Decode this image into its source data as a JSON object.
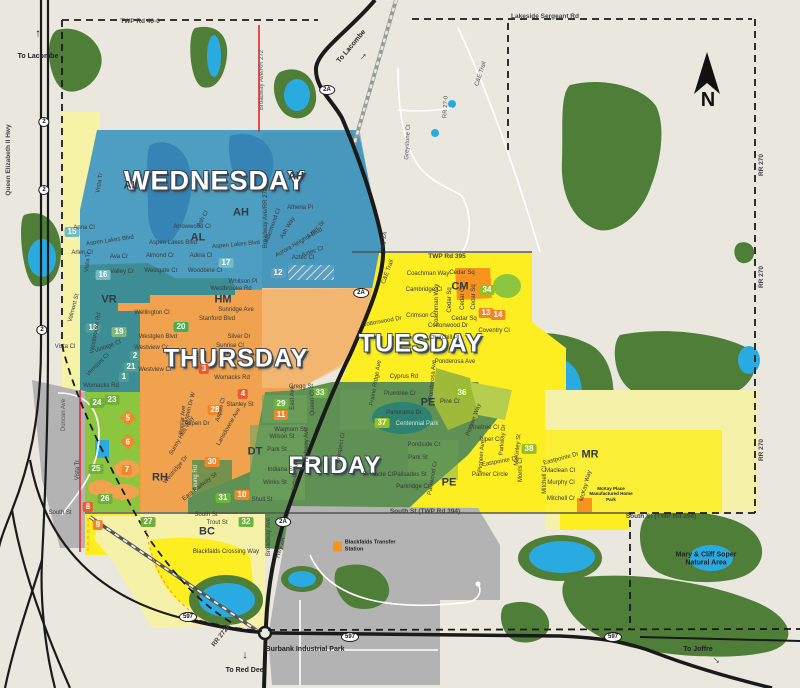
{
  "colors": {
    "background": "#EAE8DE",
    "wednesday_blue": "#4E9EC1",
    "wednesday_teal": "#3D8D95",
    "thursday_orange": "#F0A24E",
    "tuesday_yellow": "#FCEE21",
    "tuesday_pale": "#F5F1A9",
    "friday_green": "#5E9153",
    "green_space": "#8CC63F",
    "forest": "#4F7E38",
    "water": "#29ABE2",
    "industrial_gray": "#B3B3B3",
    "badge_orange": "#F0882B",
    "badge_green": "#6DB33F",
    "badge_teal": "#4E9E96",
    "road_red": "#E8232A"
  },
  "compass": {
    "label": "N"
  },
  "day_labels": [
    {
      "t": "WEDNESDAY",
      "x": 215,
      "y": 181,
      "s": 27
    },
    {
      "t": "THURSDAY",
      "x": 236,
      "y": 359,
      "s": 25
    },
    {
      "t": "TUESDAY",
      "x": 421,
      "y": 344,
      "s": 25
    },
    {
      "t": "FRIDAY",
      "x": 335,
      "y": 466,
      "s": 24
    }
  ],
  "area_labels": [
    {
      "t": "AH",
      "x": 296,
      "y": 177
    },
    {
      "t": "AH",
      "x": 241,
      "y": 213
    },
    {
      "t": "AL",
      "x": 131,
      "y": 186
    },
    {
      "t": "AL",
      "x": 198,
      "y": 238
    },
    {
      "t": "VR",
      "x": 109,
      "y": 300
    },
    {
      "t": "HM",
      "x": 223,
      "y": 300
    },
    {
      "t": "RH",
      "x": 160,
      "y": 478
    },
    {
      "t": "DT",
      "x": 255,
      "y": 452
    },
    {
      "t": "PE",
      "x": 428,
      "y": 403
    },
    {
      "t": "PE",
      "x": 449,
      "y": 483
    },
    {
      "t": "CM",
      "x": 460,
      "y": 287
    },
    {
      "t": "MR",
      "x": 590,
      "y": 455
    },
    {
      "t": "BC",
      "x": 207,
      "y": 532
    }
  ],
  "zone_badges": [
    {
      "n": "15",
      "x": 72,
      "y": 232,
      "bg": "#74BBC9"
    },
    {
      "n": "16",
      "x": 103,
      "y": 275,
      "bg": "#74BBC9"
    },
    {
      "n": "17",
      "x": 226,
      "y": 263,
      "bg": "#74BBC9"
    },
    {
      "n": "12",
      "x": 278,
      "y": 273,
      "bg": "#5B9EC0"
    },
    {
      "n": "18",
      "x": 93,
      "y": 328,
      "bg": "#4E9E96"
    },
    {
      "n": "19",
      "x": 119,
      "y": 332,
      "bg": "#7FB97E"
    },
    {
      "n": "20",
      "x": 181,
      "y": 327,
      "bg": "#44AF4F"
    },
    {
      "n": "2",
      "x": 135,
      "y": 356,
      "bg": "#4E9E96"
    },
    {
      "n": "21",
      "x": 131,
      "y": 367,
      "bg": "#4E9E96"
    },
    {
      "n": "1",
      "x": 124,
      "y": 377,
      "bg": "#4E9E96"
    },
    {
      "n": "3",
      "x": 204,
      "y": 369,
      "bg": "#F0592B"
    },
    {
      "n": "4",
      "x": 243,
      "y": 394,
      "bg": "#F0592B"
    },
    {
      "n": "28",
      "x": 215,
      "y": 410,
      "bg": "#F0882B"
    },
    {
      "n": "29",
      "x": 281,
      "y": 404,
      "bg": "#6DB33F"
    },
    {
      "n": "11",
      "x": 281,
      "y": 415,
      "bg": "#F0882B"
    },
    {
      "n": "33",
      "x": 320,
      "y": 393,
      "bg": "#6DB33F"
    },
    {
      "n": "30",
      "x": 212,
      "y": 462,
      "bg": "#F0882B"
    },
    {
      "n": "31",
      "x": 223,
      "y": 498,
      "bg": "#6DB33F"
    },
    {
      "n": "10",
      "x": 242,
      "y": 495,
      "bg": "#F0882B"
    },
    {
      "n": "32",
      "x": 246,
      "y": 522,
      "bg": "#6DB33F"
    },
    {
      "n": "23",
      "x": 112,
      "y": 400,
      "bg": "#6FAF3A"
    },
    {
      "n": "24",
      "x": 97,
      "y": 403,
      "bg": "#6FAF3A"
    },
    {
      "n": "25",
      "x": 96,
      "y": 469,
      "bg": "#6FAF3A"
    },
    {
      "n": "26",
      "x": 105,
      "y": 499,
      "bg": "#6FAF3A"
    },
    {
      "n": "27",
      "x": 148,
      "y": 522,
      "bg": "#6FAF3A"
    },
    {
      "n": "7",
      "x": 127,
      "y": 470,
      "bg": "#F0882B"
    },
    {
      "n": "8",
      "x": 88,
      "y": 507,
      "bg": "#F0592B"
    },
    {
      "n": "9",
      "x": 98,
      "y": 525,
      "bg": "#F0882B"
    },
    {
      "n": "34",
      "x": 487,
      "y": 290,
      "bg": "#95C11F"
    },
    {
      "n": "13",
      "x": 486,
      "y": 313,
      "bg": "#F0882B"
    },
    {
      "n": "14",
      "x": 498,
      "y": 315,
      "bg": "#F0882B"
    },
    {
      "n": "36",
      "x": 462,
      "y": 393,
      "bg": "#95C11F"
    },
    {
      "n": "37",
      "x": 382,
      "y": 423,
      "bg": "#95C11F"
    },
    {
      "n": "38",
      "x": 529,
      "y": 449,
      "bg": "#95C11F"
    }
  ],
  "zone_markers": [
    {
      "n": "5",
      "x": 128,
      "y": 418,
      "bg": "#F0882B"
    },
    {
      "n": "6",
      "x": 128,
      "y": 442,
      "bg": "#F0882B"
    }
  ],
  "streets": [
    {
      "t": "Vista Tr",
      "x": 100,
      "y": 183,
      "r": -80
    },
    {
      "t": "Anna Cl",
      "x": 84,
      "y": 228
    },
    {
      "t": "Arlen Cl",
      "x": 82,
      "y": 253
    },
    {
      "t": "Ava Cr",
      "x": 119,
      "y": 257
    },
    {
      "t": "Valley Cr",
      "x": 122,
      "y": 272
    },
    {
      "t": "Aspen Lakes Blvd",
      "x": 110,
      "y": 241,
      "r": -8
    },
    {
      "t": "Aspen Lakes Blvd",
      "x": 173,
      "y": 243
    },
    {
      "t": "Aspen Lakes Blvd",
      "x": 236,
      "y": 245,
      "r": -5
    },
    {
      "t": "Arrowwood Cl",
      "x": 192,
      "y": 227
    },
    {
      "t": "Almond Cr",
      "x": 160,
      "y": 256
    },
    {
      "t": "Westgate Cr",
      "x": 161,
      "y": 271
    },
    {
      "t": "Adina Cl",
      "x": 201,
      "y": 256
    },
    {
      "t": "Woodbine Cl",
      "x": 205,
      "y": 271
    },
    {
      "t": "Ash Cl",
      "x": 203,
      "y": 219,
      "r": -60
    },
    {
      "t": "Athena Pl",
      "x": 300,
      "y": 208
    },
    {
      "t": "Aldermond Cl",
      "x": 273,
      "y": 226,
      "r": -70
    },
    {
      "t": "Ash Way",
      "x": 288,
      "y": 228,
      "r": -60
    },
    {
      "t": "Aurora Heights Blvd",
      "x": 299,
      "y": 243,
      "r": -30
    },
    {
      "t": "Aztec St",
      "x": 316,
      "y": 230,
      "r": -45
    },
    {
      "t": "Aztec Cl",
      "x": 303,
      "y": 258
    },
    {
      "t": "Aztec Cr",
      "x": 313,
      "y": 252,
      "r": -20
    },
    {
      "t": "Vista Tr",
      "x": 88,
      "y": 262,
      "r": -85
    },
    {
      "t": "Valmont St",
      "x": 74,
      "y": 308,
      "r": -75
    },
    {
      "t": "Westbrooke Rd",
      "x": 96,
      "y": 333,
      "r": -80
    },
    {
      "t": "Vintage Cl",
      "x": 108,
      "y": 347,
      "r": -20
    },
    {
      "t": "Vermont Cl",
      "x": 98,
      "y": 365,
      "r": -45
    },
    {
      "t": "Vista Cl",
      "x": 65,
      "y": 347
    },
    {
      "t": "Womacks Rd",
      "x": 101,
      "y": 386
    },
    {
      "t": "Vista Tr",
      "x": 78,
      "y": 470,
      "r": -90
    },
    {
      "t": "Duncan Ave",
      "x": 64,
      "y": 415,
      "r": -90,
      "c": "#555"
    },
    {
      "t": "Whitson Pl",
      "x": 243,
      "y": 282
    },
    {
      "t": "Westbrooke Rd",
      "x": 231,
      "y": 289
    },
    {
      "t": "Wellington Cl",
      "x": 152,
      "y": 313
    },
    {
      "t": "Westglen Blvd",
      "x": 158,
      "y": 337
    },
    {
      "t": "Westview Cr",
      "x": 151,
      "y": 348
    },
    {
      "t": "Westview Cr",
      "x": 155,
      "y": 370
    },
    {
      "t": "Stanford Blvd",
      "x": 217,
      "y": 319
    },
    {
      "t": "Sunridge Ave",
      "x": 236,
      "y": 310
    },
    {
      "t": "Silver Dr",
      "x": 239,
      "y": 337
    },
    {
      "t": "Sunrise Cl",
      "x": 230,
      "y": 346
    },
    {
      "t": "Womacks Rd",
      "x": 232,
      "y": 378
    },
    {
      "t": "Gregg St",
      "x": 301,
      "y": 387
    },
    {
      "t": "Stanley St",
      "x": 240,
      "y": 405
    },
    {
      "t": "Aspen Dr W",
      "x": 190,
      "y": 408,
      "r": -75
    },
    {
      "t": "Poplar Ave",
      "x": 183,
      "y": 420,
      "r": -85
    },
    {
      "t": "Aspen Dr",
      "x": 197,
      "y": 424
    },
    {
      "t": "Aspen Cl",
      "x": 221,
      "y": 410,
      "r": -75
    },
    {
      "t": "Lansdowne Ave",
      "x": 229,
      "y": 427,
      "r": -60
    },
    {
      "t": "Sunny Hills Way",
      "x": 182,
      "y": 436,
      "r": -60
    },
    {
      "t": "Westridge Dr",
      "x": 176,
      "y": 470,
      "r": -50
    },
    {
      "t": "Leung Rd",
      "x": 196,
      "y": 478,
      "r": -90,
      "c": "#eee"
    },
    {
      "t": "East Railway St",
      "x": 200,
      "y": 487,
      "r": -38
    },
    {
      "t": "East Ave",
      "x": 293,
      "y": 398,
      "r": -90
    },
    {
      "t": "Queen Cl",
      "x": 313,
      "y": 403,
      "r": -90
    },
    {
      "t": "Broadway Ave/RR 272",
      "x": 262,
      "y": 80,
      "r": -90,
      "c": "#555"
    },
    {
      "t": "Broadway Ave/RR 272",
      "x": 266,
      "y": 218,
      "r": -90
    },
    {
      "t": "Broadway Ave",
      "x": 269,
      "y": 537,
      "r": -90
    },
    {
      "t": "Hwy 2A",
      "x": 281,
      "y": 548,
      "r": -75
    },
    {
      "t": "Hwy 2A",
      "x": 384,
      "y": 242,
      "r": -80
    },
    {
      "t": "Coachman Way",
      "x": 428,
      "y": 274
    },
    {
      "t": "Cedar Sq",
      "x": 462,
      "y": 273
    },
    {
      "t": "Cambridge Cl",
      "x": 424,
      "y": 290
    },
    {
      "t": "Crimson Cl",
      "x": 421,
      "y": 316
    },
    {
      "t": "Coachman Way",
      "x": 437,
      "y": 305,
      "r": -90
    },
    {
      "t": "Cedar Sq",
      "x": 450,
      "y": 300,
      "r": -90
    },
    {
      "t": "Cedar Cl",
      "x": 463,
      "y": 298,
      "r": -90
    },
    {
      "t": "Cedar Sq",
      "x": 474,
      "y": 297,
      "r": -90
    },
    {
      "t": "Cedar Sq",
      "x": 464,
      "y": 319
    },
    {
      "t": "Cottonwood Dr",
      "x": 382,
      "y": 322,
      "r": -10
    },
    {
      "t": "Cottonwood Dr",
      "x": 448,
      "y": 326
    },
    {
      "t": "Churchill Pl",
      "x": 444,
      "y": 338
    },
    {
      "t": "Coventry Cl",
      "x": 494,
      "y": 331
    },
    {
      "t": "Ponderosa Ave",
      "x": 455,
      "y": 362
    },
    {
      "t": "Ponderosa Ave",
      "x": 433,
      "y": 380,
      "r": -85
    },
    {
      "t": "Cyprus Rd",
      "x": 404,
      "y": 377
    },
    {
      "t": "Prairie Ridge Ave",
      "x": 376,
      "y": 383,
      "r": -80
    },
    {
      "t": "Plumtree Cr",
      "x": 400,
      "y": 394
    },
    {
      "t": "Pine Cr",
      "x": 450,
      "y": 402
    },
    {
      "t": "C&E Trail",
      "x": 388,
      "y": 272,
      "r": -70
    },
    {
      "t": "Panorama Dr",
      "x": 404,
      "y": 413
    },
    {
      "t": "Centennial Park",
      "x": 417,
      "y": 424,
      "c": "#CFE8DF"
    },
    {
      "t": "Pondside Cr",
      "x": 424,
      "y": 445
    },
    {
      "t": "Park St",
      "x": 418,
      "y": 458
    },
    {
      "t": "Pinnacle Cl",
      "x": 378,
      "y": 475
    },
    {
      "t": "Palisades St",
      "x": 410,
      "y": 475
    },
    {
      "t": "Parkridge Cr",
      "x": 413,
      "y": 487
    },
    {
      "t": "Parkwood Cr",
      "x": 433,
      "y": 478,
      "r": -80
    },
    {
      "t": "Prospect Cl",
      "x": 341,
      "y": 448,
      "r": -80
    },
    {
      "t": "Pioneer Way",
      "x": 474,
      "y": 420,
      "r": -70
    },
    {
      "t": "Pinetree Cl",
      "x": 484,
      "y": 428
    },
    {
      "t": "Piper Cl",
      "x": 490,
      "y": 440
    },
    {
      "t": "Parkway Dr",
      "x": 503,
      "y": 440,
      "r": -85
    },
    {
      "t": "McKinley St",
      "x": 518,
      "y": 450,
      "r": -85
    },
    {
      "t": "Eastpointe Dr",
      "x": 500,
      "y": 462,
      "r": -10
    },
    {
      "t": "Pioneer Ave",
      "x": 482,
      "y": 456,
      "r": -85
    },
    {
      "t": "Palmer Circle",
      "x": 490,
      "y": 475
    },
    {
      "t": "Morris Cl",
      "x": 521,
      "y": 470,
      "r": -90
    },
    {
      "t": "Waghorn St",
      "x": 290,
      "y": 430
    },
    {
      "t": "Wilson St",
      "x": 282,
      "y": 437
    },
    {
      "t": "Park St",
      "x": 277,
      "y": 450
    },
    {
      "t": "Indiana St",
      "x": 281,
      "y": 470
    },
    {
      "t": "Winks St",
      "x": 275,
      "y": 483
    },
    {
      "t": "Shull St",
      "x": 262,
      "y": 500
    },
    {
      "t": "Scholar Ave",
      "x": 296,
      "y": 475,
      "r": -85
    },
    {
      "t": "Highway Ave",
      "x": 307,
      "y": 445,
      "r": -90
    },
    {
      "t": "Eastpointe Dr",
      "x": 561,
      "y": 459,
      "r": -15
    },
    {
      "t": "Maclean Cl",
      "x": 560,
      "y": 471
    },
    {
      "t": "Murphy Cl",
      "x": 561,
      "y": 483
    },
    {
      "t": "Mitchell Cr",
      "x": 561,
      "y": 499
    },
    {
      "t": "McKay Way",
      "x": 586,
      "y": 486,
      "r": -75
    },
    {
      "t": "Mitchell Cl",
      "x": 545,
      "y": 480,
      "r": -90
    },
    {
      "t": "South St",
      "x": 60,
      "y": 513
    },
    {
      "t": "South St",
      "x": 206,
      "y": 515
    },
    {
      "t": "Trout St",
      "x": 217,
      "y": 523
    },
    {
      "t": "Blackfalds Crossing Way",
      "x": 226,
      "y": 552
    },
    {
      "t": "Greystone Ct",
      "x": 408,
      "y": 142,
      "r": -87,
      "c": "#555"
    },
    {
      "t": "RR 27-0",
      "x": 446,
      "y": 107,
      "r": -87,
      "c": "#555"
    },
    {
      "t": "C&E Trail",
      "x": 481,
      "y": 74,
      "r": -72,
      "c": "#555"
    }
  ],
  "roads": [
    {
      "t": "Queen Elizabeth II Hwy",
      "x": 9,
      "y": 160,
      "r": -90
    },
    {
      "t": "RR 270",
      "x": 762,
      "y": 165,
      "r": -90
    },
    {
      "t": "RR 270",
      "x": 762,
      "y": 277,
      "r": -90
    },
    {
      "t": "RR 270",
      "x": 762,
      "y": 450,
      "r": -90
    },
    {
      "t": "RR 272A",
      "x": 222,
      "y": 636,
      "r": -52
    },
    {
      "t": "TWP Rd 40-0",
      "x": 140,
      "y": 22
    },
    {
      "t": "TWP Rd 395",
      "x": 447,
      "y": 257
    },
    {
      "t": "Lakeside Sergeant Rd",
      "x": 545,
      "y": 17
    },
    {
      "t": "South St (TWP Rd 394)",
      "x": 425,
      "y": 512
    },
    {
      "t": "South St (TWP Rd 394)",
      "x": 661,
      "y": 517
    }
  ],
  "places": [
    {
      "t": "To Lacombe",
      "x": 38,
      "y": 57
    },
    {
      "t": "To Lacombe",
      "x": 352,
      "y": 47,
      "r": -50
    },
    {
      "t": "To Red Deer",
      "x": 246,
      "y": 671
    },
    {
      "t": "To Joffre",
      "x": 698,
      "y": 650
    },
    {
      "t": "Burbank Industrial Park",
      "x": 305,
      "y": 650
    },
    {
      "t": "Mary & Cliff Soper Natural Area",
      "x": 706,
      "y": 560,
      "w": 80
    },
    {
      "t": "McKay Place Manufactured Home Park",
      "x": 611,
      "y": 494,
      "w": 52,
      "s": 4.5
    },
    {
      "t": "Blackfalds Transfer Station",
      "x": 370,
      "y": 546,
      "w": 60,
      "s": 5.5,
      "icon": true
    }
  ],
  "shields": [
    {
      "t": "2",
      "x": 44,
      "y": 122
    },
    {
      "t": "2",
      "x": 44,
      "y": 190
    },
    {
      "t": "2",
      "x": 42,
      "y": 330
    },
    {
      "t": "2A",
      "x": 327,
      "y": 90
    },
    {
      "t": "2A",
      "x": 361,
      "y": 293
    },
    {
      "t": "2A",
      "x": 283,
      "y": 522
    },
    {
      "t": "597",
      "x": 188,
      "y": 617
    },
    {
      "t": "597",
      "x": 350,
      "y": 637
    },
    {
      "t": "597",
      "x": 613,
      "y": 637
    }
  ],
  "arrows": [
    {
      "x": 38,
      "y": 34,
      "r": 0
    },
    {
      "x": 363,
      "y": 57,
      "r": 40
    },
    {
      "x": 245,
      "y": 655,
      "r": 180
    },
    {
      "x": 716,
      "y": 660,
      "r": 135
    }
  ]
}
